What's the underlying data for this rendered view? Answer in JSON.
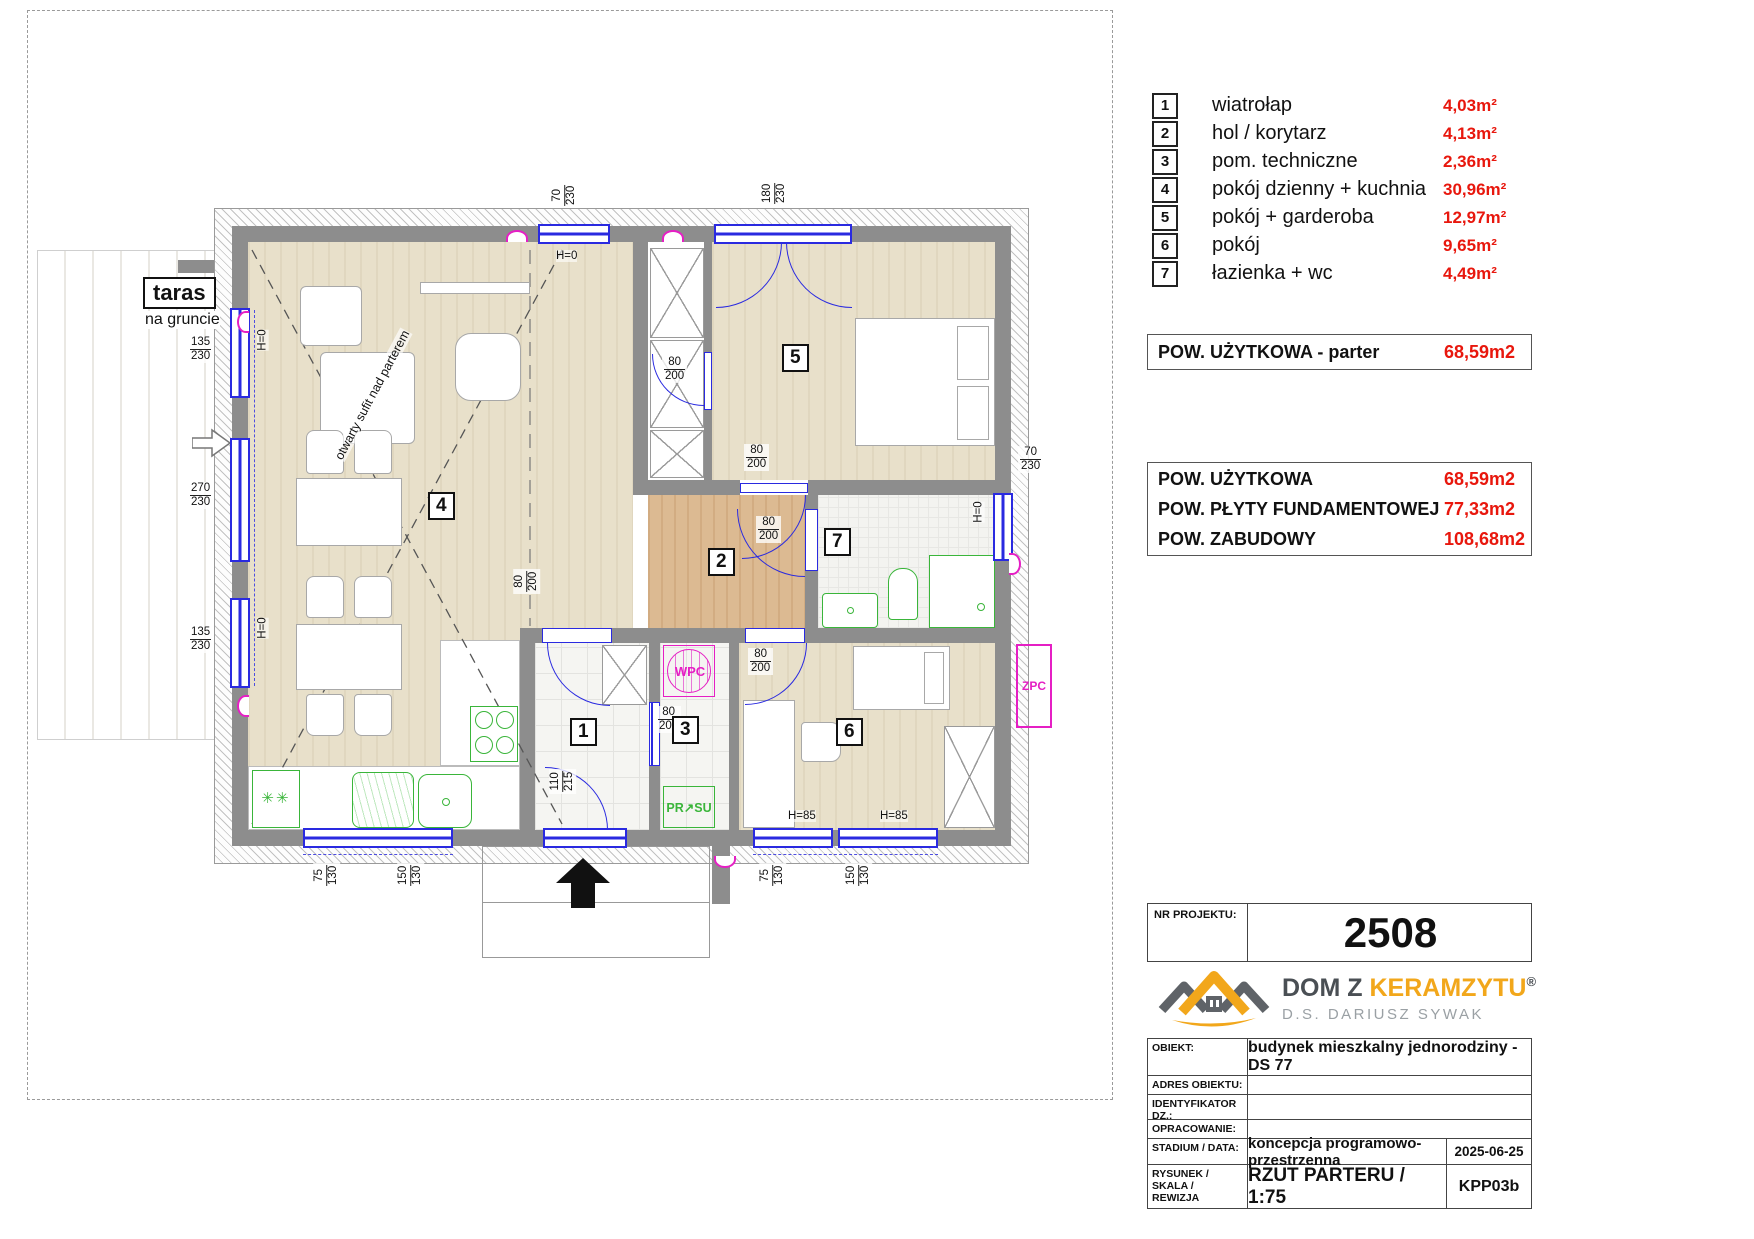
{
  "plan": {
    "terrace": {
      "title": "taras",
      "subtitle": "na gruncie"
    },
    "open_ceiling_note": "otwarty sufit nad parterem",
    "labels": {
      "h0": "H=0",
      "h85": "H=85",
      "wpc": "WPC",
      "zpc": "ZPC",
      "prsu": "PR↗SU"
    },
    "dims": {
      "d70_230": {
        "a": "70",
        "b": "230"
      },
      "d180_230": {
        "a": "180",
        "b": "230"
      },
      "d135_230": {
        "a": "135",
        "b": "230"
      },
      "d270_230": {
        "a": "270",
        "b": "230"
      },
      "d75_130": {
        "a": "75",
        "b": "130"
      },
      "d150_130": {
        "a": "150",
        "b": "130"
      },
      "d110_215": {
        "a": "110",
        "b": "215"
      },
      "d80_200": {
        "a": "80",
        "b": "200"
      }
    }
  },
  "legend": {
    "rooms": [
      {
        "num": "1",
        "name": "wiatrołap",
        "area": "4,03m²"
      },
      {
        "num": "2",
        "name": "hol / korytarz",
        "area": "4,13m²"
      },
      {
        "num": "3",
        "name": "pom. techniczne",
        "area": "2,36m²"
      },
      {
        "num": "4",
        "name": "pokój dzienny + kuchnia",
        "area": "30,96m²"
      },
      {
        "num": "5",
        "name": "pokój + garderoba",
        "area": "12,97m²"
      },
      {
        "num": "6",
        "name": "pokój",
        "area": "9,65m²"
      },
      {
        "num": "7",
        "name": "łazienka + wc",
        "area": "4,49m²"
      }
    ]
  },
  "summary1": {
    "label": "POW. UŻYTKOWA - parter",
    "value": "68,59m2"
  },
  "summary2": {
    "rows": [
      {
        "label": "POW. UŻYTKOWA",
        "value": "68,59m2"
      },
      {
        "label": "POW. PŁYTY FUNDAMENTOWEJ",
        "value": "77,33m2"
      },
      {
        "label": "POW. ZABUDOWY",
        "value": "108,68m2"
      }
    ]
  },
  "titleblock": {
    "project_no_label": "NR PROJEKTU:",
    "project_no": "2508",
    "brand": {
      "name_dark": "DOM Z ",
      "name_accent": "KERAMZYTU",
      "reg": "®",
      "sub": "D.S. DARIUSZ SYWAK"
    },
    "rows": [
      {
        "label": "OBIEKT:",
        "value": "budynek mieszkalny jednorodziny - DS 77"
      },
      {
        "label": "ADRES OBIEKTU:",
        "value": ""
      },
      {
        "label": "IDENTYFIKATOR DZ.:",
        "value": ""
      },
      {
        "label": "OPRACOWANIE:",
        "value": ""
      }
    ],
    "stadium": {
      "label": "STADIUM / DATA:",
      "value": "koncepcja programowo-przestrzenna",
      "date": "2025-06-25"
    },
    "rysunek": {
      "label": "RYSUNEK / SKALA / REWIZJA",
      "value": "RZUT PARTERU / 1:75",
      "rev": "KPP03b"
    }
  },
  "colors": {
    "accent_red": "#e8170d",
    "brand_orange": "#f2a71b",
    "window_blue": "#2a2ae0",
    "fixture_green": "#3ab53a",
    "symbol_magenta": "#e51fc4",
    "wall_gray": "#8d8d8d"
  }
}
